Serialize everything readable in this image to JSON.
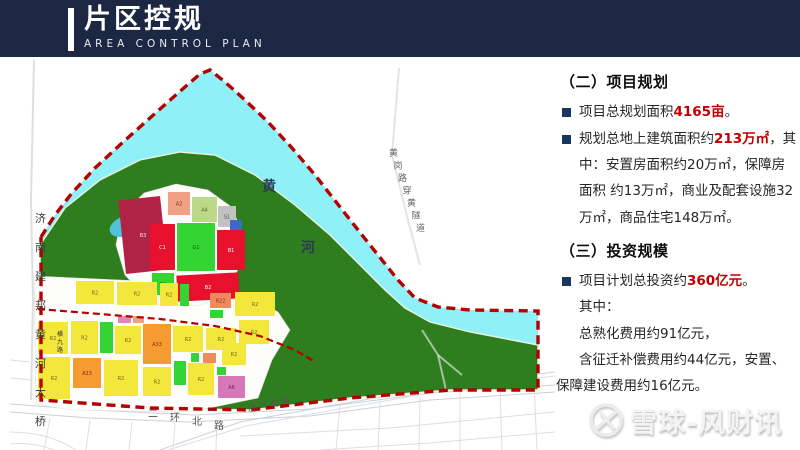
{
  "header": {
    "title": "片区控规",
    "subtitle": "AREA CONTROL PLAN",
    "bg_color": "#1C2743",
    "accent_color": "#FFFFFF"
  },
  "panel": {
    "emphasis_color": "#C00000",
    "bullet_color": "#17375E",
    "section2": {
      "heading": "（二）项目规划",
      "bullets": [
        {
          "pre": "项目总规划面积",
          "em": "4165亩",
          "post": "。"
        },
        {
          "pre": "规划总地上建筑面积约",
          "em": "213万㎡",
          "post": "，其中：安置房面积约20万㎡，保障房面积 约13万㎡，商业及配套设施32万㎡，商品住宅148万㎡。"
        }
      ]
    },
    "section3": {
      "heading": "（三）投资规模",
      "bullets": [
        {
          "pre": "项目计划总投资约",
          "em": "360亿元",
          "post": "。"
        }
      ],
      "lines": [
        "其中：",
        "总熟化费用约91亿元，",
        "含征迁补偿费用约44亿元，安置、保障建设费用约16亿元。"
      ]
    }
  },
  "map": {
    "colors": {
      "river": "#8FF0F8",
      "hill_green": "#2E7D1F",
      "boundary_red": "#B30000",
      "residential_yellow": "#F3E73C",
      "commercial_red": "#E8112D",
      "crimson": "#B02346",
      "orange": "#F59B31",
      "park_green": "#35D435",
      "light_green": "#BCD98A",
      "salmon": "#F2A083",
      "pink": "#D877B8",
      "gray": "#C2C2C2",
      "blue": "#3F6BBF",
      "pond": "#4FC3D9"
    },
    "labels": [
      {
        "text": "黄",
        "x": 252,
        "y": 131,
        "size": 14,
        "color": "#2A3B55",
        "bold": true
      },
      {
        "text": "河",
        "x": 291,
        "y": 192,
        "size": 14,
        "color": "#2A3B55",
        "bold": true
      },
      {
        "text": "济南建邦黄河大桥",
        "x": 25,
        "y": 162,
        "step": [
          0,
          29
        ],
        "size": 11,
        "color": "#3A3A3A"
      },
      {
        "text": "黄岗路穿黄隧道",
        "x": 379,
        "y": 96,
        "step": [
          4.5,
          12.5
        ],
        "size": 9,
        "color": "#666666"
      },
      {
        "text": "横九路",
        "x": 47,
        "y": 276,
        "step": [
          0,
          8
        ],
        "size": 6,
        "color": "#333333"
      },
      {
        "text": "二环北路",
        "x": 138,
        "y": 357,
        "step": [
          22,
          4
        ],
        "size": 10,
        "color": "#555555"
      },
      {
        "text": "济广高速",
        "x": 238,
        "y": 351,
        "step": [
          11,
          -2.5
        ],
        "size": 8.5,
        "color": "#555555"
      }
    ],
    "parcels": [
      {
        "label": "B3",
        "x": 112,
        "y": 138,
        "w": 42,
        "h": 74,
        "c": "#B02346",
        "t": "#FFD9E0",
        "rot": -6
      },
      {
        "label": "A2",
        "x": 158,
        "y": 132,
        "w": 22,
        "h": 23,
        "c": "#F2A083",
        "t": "#7A3020"
      },
      {
        "label": "A4",
        "x": 182,
        "y": 137,
        "w": 25,
        "h": 25,
        "c": "#BCD98A",
        "t": "#4A6B2A"
      },
      {
        "label": "S1",
        "x": 208,
        "y": 146,
        "w": 18,
        "h": 21,
        "c": "#C2C2C2",
        "t": "#555555"
      },
      {
        "label": "A1",
        "x": 220,
        "y": 160,
        "w": 12,
        "h": 13,
        "c": "#3F6BBF",
        "t": "#FFFFFF"
      },
      {
        "label": "C1",
        "x": 140,
        "y": 164,
        "w": 25,
        "h": 46,
        "c": "#E8112D",
        "t": "#FFFFFF"
      },
      {
        "label": "G1",
        "x": 167,
        "y": 163,
        "w": 38,
        "h": 48,
        "c": "#35D435",
        "t": "#0A5A0A"
      },
      {
        "label": "B1",
        "x": 207,
        "y": 170,
        "w": 28,
        "h": 40,
        "c": "#E8112D",
        "t": "#FFFFFF"
      },
      {
        "label": "B2",
        "x": 167,
        "y": 214,
        "w": 62,
        "h": 26,
        "c": "#E8112D",
        "t": "#FFFFFF",
        "rot": -3
      },
      {
        "label": "G1",
        "x": 142,
        "y": 213,
        "w": 22,
        "h": 22,
        "c": "#35D435",
        "t": "#0A5A0A"
      },
      {
        "label": "R2",
        "x": 66,
        "y": 221,
        "w": 38,
        "h": 23,
        "c": "#F3E73C",
        "t": "#6B6B1A"
      },
      {
        "label": "R2",
        "x": 107,
        "y": 222,
        "w": 40,
        "h": 23,
        "c": "#F3E73C",
        "t": "#6B6B1A"
      },
      {
        "label": "R2",
        "x": 150,
        "y": 223,
        "w": 18,
        "h": 23,
        "c": "#F3E73C",
        "t": "#6B6B1A"
      },
      {
        "label": "G1",
        "x": 170,
        "y": 224,
        "w": 9,
        "h": 22,
        "c": "#35D435",
        "t": "#0A5A0A"
      },
      {
        "label": "R22",
        "x": 200,
        "y": 233,
        "w": 21,
        "h": 15,
        "c": "#F08A5C",
        "t": "#7A3020"
      },
      {
        "label": "G1",
        "x": 200,
        "y": 250,
        "w": 13,
        "h": 8,
        "c": "#35D435",
        "t": "#0A5A0A"
      },
      {
        "label": "R2",
        "x": 225,
        "y": 232,
        "w": 40,
        "h": 24,
        "c": "#F3E73C",
        "t": "#6B6B1A"
      },
      {
        "label": "R2",
        "x": 28,
        "y": 262,
        "w": 30,
        "h": 32,
        "c": "#F3E73C",
        "t": "#6B6B1A"
      },
      {
        "label": "R2",
        "x": 61,
        "y": 261,
        "w": 27,
        "h": 33,
        "c": "#F3E73C",
        "t": "#6B6B1A"
      },
      {
        "label": "G1",
        "x": 90,
        "y": 262,
        "w": 13,
        "h": 31,
        "c": "#35D435",
        "t": "#0A5A0A"
      },
      {
        "label": "A1",
        "x": 108,
        "y": 256,
        "w": 13,
        "h": 7,
        "c": "#E585B5",
        "t": "#7A1A5A"
      },
      {
        "label": "A5",
        "x": 123,
        "y": 256,
        "w": 11,
        "h": 7,
        "c": "#F2A083",
        "t": "#7A3020"
      },
      {
        "label": "R2",
        "x": 105,
        "y": 266,
        "w": 26,
        "h": 28,
        "c": "#F3E73C",
        "t": "#6B6B1A"
      },
      {
        "label": "A33",
        "x": 133,
        "y": 264,
        "w": 28,
        "h": 40,
        "c": "#F59B31",
        "t": "#8A2B00"
      },
      {
        "label": "R2",
        "x": 163,
        "y": 266,
        "w": 30,
        "h": 26,
        "c": "#F3E73C",
        "t": "#6B6B1A"
      },
      {
        "label": "R2",
        "x": 196,
        "y": 268,
        "w": 30,
        "h": 22,
        "c": "#F3E73C",
        "t": "#6B6B1A"
      },
      {
        "label": "R2",
        "x": 229,
        "y": 260,
        "w": 30,
        "h": 24,
        "c": "#F3E73C",
        "t": "#6B6B1A"
      },
      {
        "label": "R2",
        "x": 28,
        "y": 297,
        "w": 32,
        "h": 42,
        "c": "#F3E73C",
        "t": "#6B6B1A"
      },
      {
        "label": "A23",
        "x": 63,
        "y": 298,
        "w": 28,
        "h": 30,
        "c": "#F59B31",
        "t": "#8A2B00"
      },
      {
        "label": "R2",
        "x": 94,
        "y": 300,
        "w": 34,
        "h": 36,
        "c": "#F3E73C",
        "t": "#6B6B1A"
      },
      {
        "label": "R2",
        "x": 133,
        "y": 307,
        "w": 28,
        "h": 29,
        "c": "#F3E73C",
        "t": "#6B6B1A"
      },
      {
        "label": "G1",
        "x": 164,
        "y": 301,
        "w": 12,
        "h": 24,
        "c": "#35D435",
        "t": "#0A5A0A"
      },
      {
        "label": "R2",
        "x": 178,
        "y": 303,
        "w": 26,
        "h": 32,
        "c": "#F3E73C",
        "t": "#6B6B1A"
      },
      {
        "label": "G1",
        "x": 181,
        "y": 293,
        "w": 8,
        "h": 9,
        "c": "#35D435",
        "t": "#0A5A0A"
      },
      {
        "label": "R22",
        "x": 193,
        "y": 293,
        "w": 13,
        "h": 10,
        "c": "#F08A5C",
        "t": "#7A3020"
      },
      {
        "label": "R2",
        "x": 212,
        "y": 283,
        "w": 24,
        "h": 22,
        "c": "#F3E73C",
        "t": "#6B6B1A"
      },
      {
        "label": "G1",
        "x": 207,
        "y": 307,
        "w": 9,
        "h": 8,
        "c": "#35D435",
        "t": "#0A5A0A"
      },
      {
        "label": "A6",
        "x": 208,
        "y": 316,
        "w": 27,
        "h": 22,
        "c": "#D877B8",
        "t": "#7A1A5A"
      }
    ]
  },
  "watermark": {
    "text": "雪球-风财讯",
    "logo": "snowball-logo"
  }
}
